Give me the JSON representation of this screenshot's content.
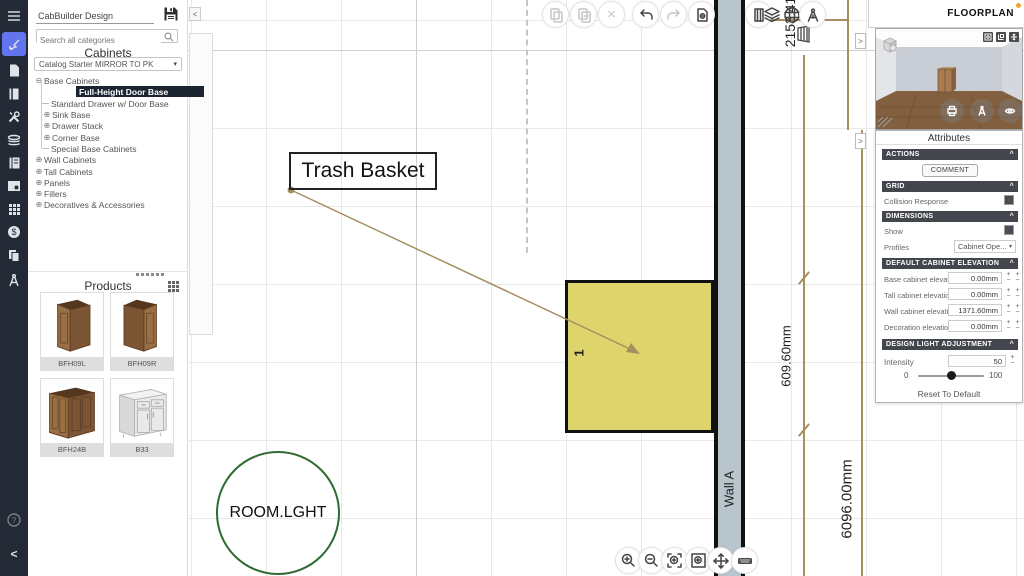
{
  "app": {
    "design_name": "CabBuilder Design",
    "floorplan_label": "FLOORPLAN",
    "floorplan_status_color": "#eda52f"
  },
  "glyphs": {
    "chevron_up": "^",
    "dropdown": "▾",
    "collapse_left": "<",
    "collapse_right": ">",
    "plus": "+",
    "minus": "−",
    "delete": "×",
    "help": "?"
  },
  "rail": {
    "icons": [
      "menu",
      "draw-design",
      "catalog-document",
      "door-styles",
      "tools",
      "material-layers",
      "report-book",
      "render-screen",
      "parts-grid",
      "pricing-dollar",
      "copy-documents",
      "drafting-compass"
    ],
    "bottom_icons": [
      "help",
      "collapse-left"
    ],
    "active_color": "#6274ee"
  },
  "sidebar": {
    "search_placeholder": "Search all categories",
    "section_title": "Cabinets",
    "catalog_value": "Catalog Starter MIRROR TO PK",
    "tree": [
      {
        "glyph": "⊖",
        "label": "Base Cabinets"
      },
      {
        "glyph": "",
        "label": "Full-Height Door Base"
      },
      {
        "glyph": "",
        "label": "Standard Drawer w/ Door Base"
      },
      {
        "glyph": "⊕",
        "label": "Sink Base"
      },
      {
        "glyph": "⊕",
        "label": "Drawer Stack"
      },
      {
        "glyph": "⊕",
        "label": "Corner Base"
      },
      {
        "glyph": "",
        "label": "Special Base Cabinets"
      },
      {
        "glyph": "⊕",
        "label": "Wall Cabinets"
      },
      {
        "glyph": "⊕",
        "label": "Tall Cabinets"
      },
      {
        "glyph": "⊕",
        "label": "Panels"
      },
      {
        "glyph": "⊕",
        "label": "Fillers"
      },
      {
        "glyph": "⊕",
        "label": "Decoratives & Accessories"
      }
    ],
    "products_title": "Products",
    "products": [
      {
        "code": "BFH09L"
      },
      {
        "code": "BFH09R"
      },
      {
        "code": "BFH24B"
      },
      {
        "code": "B33"
      }
    ]
  },
  "palette": {
    "tools": [
      "room",
      "door",
      "window",
      "window-framed",
      "base-cabinet",
      "faucet",
      "pendant-light",
      "duplicate",
      "countertop-shape",
      "tile",
      "board",
      "marker",
      "settings"
    ],
    "selected_tool": "window-framed"
  },
  "top_toolbar": {
    "buttons": [
      "copy",
      "duplicate",
      "delete",
      "undo",
      "redo",
      "document-settings",
      "door-panel",
      "layers",
      "grid-globe",
      "wall-cabinet",
      "drafting-compass"
    ]
  },
  "bottom_toolbar": {
    "buttons": [
      "zoom-in",
      "zoom-out",
      "zoom-selection",
      "zoom-fit",
      "pan",
      "measure-keyboard"
    ]
  },
  "canvas": {
    "trash_label": "Trash Basket",
    "room_light_label": "ROOM.LGHT",
    "wall_label": "Wall A",
    "cabinet_number": "1",
    "dim_top": "2153.41",
    "dim_cabinet": "609.60mm",
    "dim_room": "6096.00mm",
    "colors": {
      "cabinet_fill": "#ddd56b",
      "wall_fill": "#b9c5cd",
      "dimension": "#a58f60",
      "room_light_ring": "#2f6b30"
    }
  },
  "preview": {
    "corner_icons": [
      "snapshot",
      "layout",
      "expand"
    ],
    "overlay_icons": [
      "print",
      "drafting-compass",
      "orbit-view"
    ],
    "cube_icon": "view-cube"
  },
  "attributes": {
    "title": "Attributes",
    "actions": {
      "title": "ACTIONS",
      "comment_button": "COMMENT"
    },
    "grid": {
      "title": "GRID",
      "collision_label": "Collision Response"
    },
    "dimensions": {
      "title": "DIMENSIONS",
      "show_label": "Show",
      "profiles_label": "Profiles",
      "profiles_value": "Cabinet Ope..."
    },
    "elevation": {
      "title": "DEFAULT CABINET ELEVATION",
      "rows": [
        {
          "label": "Base cabinet elevation",
          "value": "0.00mm"
        },
        {
          "label": "Tall cabinet elevation",
          "value": "0.00mm"
        },
        {
          "label": "Wall cabinet elevation",
          "value": "1371.60mm"
        },
        {
          "label": "Decoration elevation",
          "value": "0.00mm"
        }
      ]
    },
    "light": {
      "title": "DESIGN LIGHT ADJUSTMENT",
      "intensity_label": "Intensity",
      "intensity_value": "50",
      "slider_min": "0",
      "slider_max": "100",
      "reset_label": "Reset To Default"
    }
  }
}
